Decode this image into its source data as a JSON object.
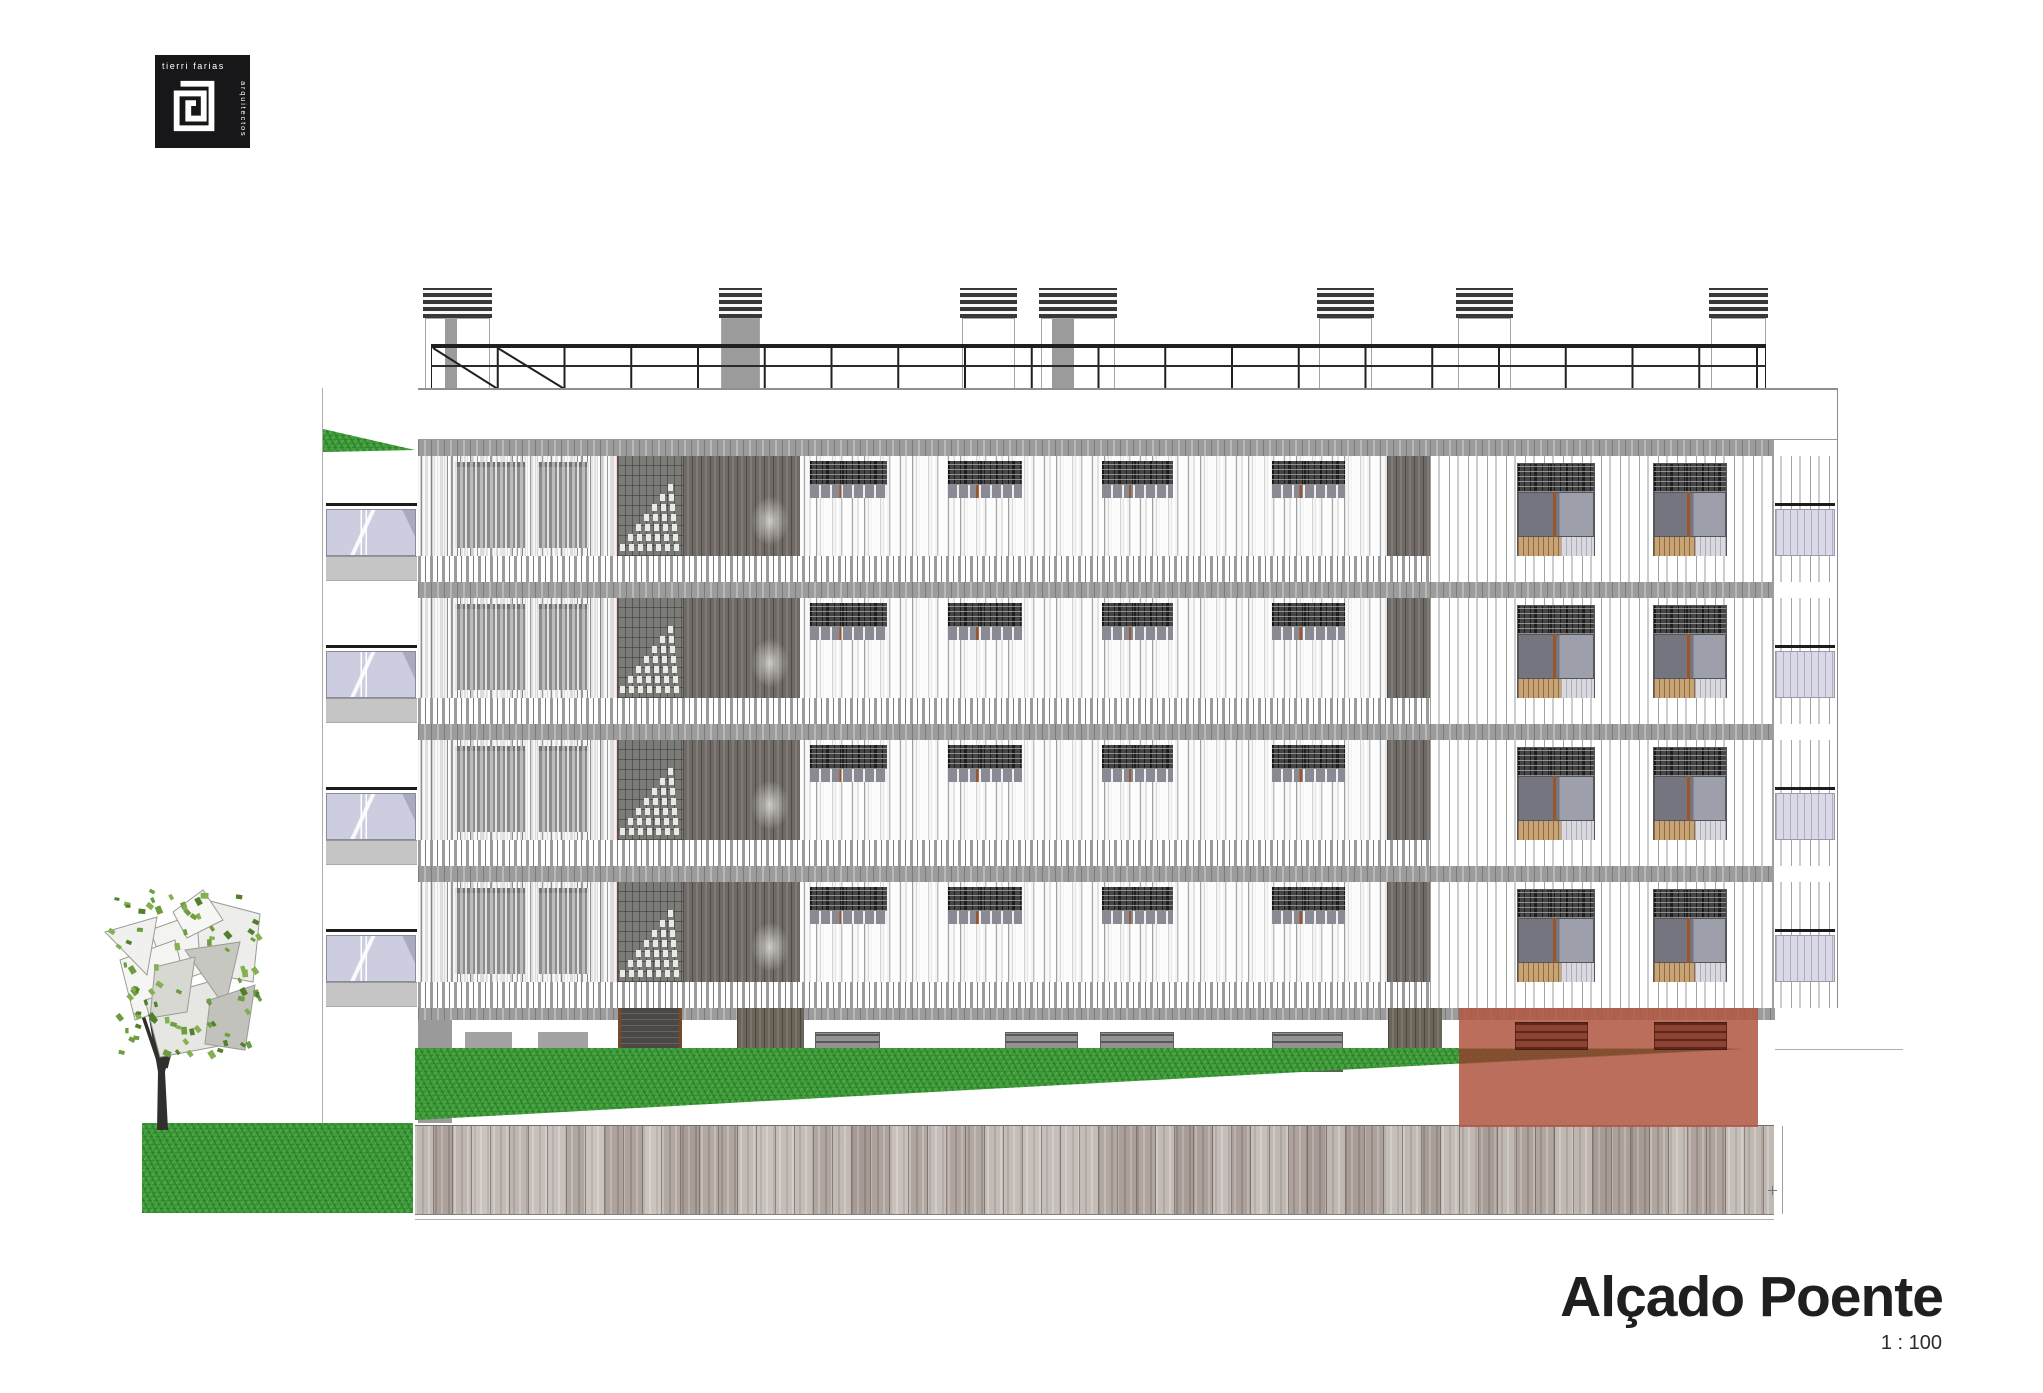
{
  "logo": {
    "text_top": "tierri farias",
    "text_side": "arquitectos",
    "bg": "#17171a"
  },
  "title": {
    "text": "Alçado Poente",
    "scale_label": "1 : 100"
  },
  "colors": {
    "paper": "#ffffff",
    "band_gray": "#9c9c9c",
    "pier_dark": "#6f6a66",
    "glass_blue": "#cdcde0",
    "grass_green": "#3f9e3b",
    "wood_gray": "#b3a9a3",
    "red_overlay": "rgba(177,89,68,0.87)",
    "accent_orange": "#9a552a",
    "rail_black": "#1c1c1c"
  },
  "drawing": {
    "floors": {
      "count": 4,
      "top": 440,
      "pitch": 142,
      "band_h": 16,
      "field_h": 100,
      "stub_h": 26
    },
    "facade": {
      "left": 418,
      "right": 1837,
      "zoneA": [
        418,
        617
      ],
      "tower": [
        617,
        683
      ],
      "pier1": [
        683,
        800
      ],
      "zoneB": [
        800,
        1387
      ],
      "pier2": [
        1387,
        1430
      ],
      "zoneC": [
        1430,
        1837
      ],
      "recess_x": 1773
    },
    "parapet": {
      "x": 323,
      "w": 1514,
      "y": 388,
      "h": 52
    },
    "top_wedge": {
      "x": 323,
      "y": 427,
      "w": 92,
      "h": 25
    },
    "left_column": {
      "x": 322,
      "y": 388,
      "w": 96,
      "h": 735
    },
    "chimneys": [
      {
        "x": 423,
        "w": 69,
        "stripe": [
          20,
          12
        ]
      },
      {
        "x": 719,
        "w": 43,
        "gray": true
      },
      {
        "x": 960,
        "w": 57
      },
      {
        "x": 1039,
        "w": 78,
        "stripe": [
          11,
          22
        ]
      },
      {
        "x": 1317,
        "w": 57
      },
      {
        "x": 1456,
        "w": 57
      },
      {
        "x": 1709,
        "w": 59
      }
    ],
    "chimney_cap": {
      "y": 288,
      "h": 30
    },
    "chimney_body": {
      "y": 318,
      "h": 70
    },
    "railing": {
      "x1": 431,
      "x2": 1766,
      "y_top": 342,
      "y_mid": 366,
      "y_bot": 388,
      "posts": 21,
      "diagonals": 2
    },
    "windows_A": [
      {
        "x": 455,
        "w": 70
      },
      {
        "x": 537,
        "w": 52
      }
    ],
    "grilles_B": [
      {
        "x": 810,
        "w": 77
      },
      {
        "x": 948,
        "w": 74
      },
      {
        "x": 1102,
        "w": 71
      },
      {
        "x": 1272,
        "w": 73
      }
    ],
    "windows_C": [
      {
        "x": 1517,
        "w": 78
      },
      {
        "x": 1653,
        "w": 74
      }
    ],
    "balconies_left": {
      "x": 326,
      "w": 91,
      "rail_dy": 63,
      "glass_dy": 69,
      "glass_h": 47,
      "slab_dy": 116,
      "slab_h": 25
    },
    "balconies_right": {
      "x": 1775,
      "w": 60,
      "rail_dy": 63,
      "glass_dy": 69,
      "glass_h": 47
    },
    "ground": {
      "band_y": 1008,
      "band_h": 12,
      "wall_y": 1020,
      "wall_h": 105,
      "wall_x": 418,
      "wall_r": 1775,
      "corner_pier": {
        "x": 418,
        "w": 34,
        "y": 1020,
        "h": 103
      },
      "openings": [
        {
          "x": 465,
          "w": 47,
          "notch": "right"
        },
        {
          "x": 538,
          "w": 50,
          "notch": "left"
        }
      ],
      "opening_y": 1032,
      "opening_h": 40,
      "door": {
        "x": 618,
        "w": 64,
        "y": 1008,
        "h": 66
      },
      "piers": [
        {
          "x": 737,
          "w": 67,
          "y": 1008,
          "h": 42
        },
        {
          "x": 1388,
          "w": 54,
          "y": 1008,
          "h": 41
        }
      ],
      "vents": [
        {
          "x": 815,
          "w": 65
        },
        {
          "x": 1005,
          "w": 73
        },
        {
          "x": 1100,
          "w": 74
        },
        {
          "x": 1272,
          "w": 71
        }
      ],
      "vent_y": 1032,
      "vent_h": 40
    },
    "grass_wedge": {
      "x": 415,
      "y": 1048,
      "w": 1330,
      "h": 72
    },
    "wood_wall": {
      "x": 415,
      "y": 1125,
      "w": 1359,
      "h": 90,
      "plank_w": 19
    },
    "under_line": {
      "x": 415,
      "y": 1219,
      "w": 1359
    },
    "grass_block": {
      "x": 142,
      "y": 1123,
      "w": 271,
      "h": 90
    },
    "red_box": {
      "x": 1459,
      "y": 1008,
      "w": 299,
      "h": 119,
      "grilles": [
        {
          "x": 56,
          "w": 73
        },
        {
          "x": 195,
          "w": 73
        }
      ],
      "grille_dy": 14,
      "grille_h": 28,
      "diag": "0,41 286,41 0,56"
    },
    "ground_line_right": {
      "x": 1775,
      "y": 1049,
      "w": 128
    },
    "tick": {
      "x": 1768,
      "y": 1190
    },
    "tree": {
      "x": 95,
      "y": 872,
      "w": 185,
      "h": 262,
      "trunk_path": "M62,258 L73,258 L70,200 L84,140 L78,137 L68,182 L60,144 L54,146 L63,200 Z",
      "branches": [
        "71,196 90,120",
        "67,200 45,135"
      ],
      "polys": [
        {
          "pts": "55,58 120,35 140,90 75,112",
          "fill": "#f3f3f1"
        },
        {
          "pts": "100,25 165,42 158,110 106,100",
          "fill": "#ededeb"
        },
        {
          "pts": "25,88 80,68 95,130 40,148",
          "fill": "#f5f5f3"
        },
        {
          "pts": "50,128 120,108 135,172 65,185",
          "fill": "#e6e6e2"
        },
        {
          "pts": "90,78 145,70 130,135",
          "fill": "#c7c7c1"
        },
        {
          "pts": "10,60 62,45 52,103",
          "fill": "#f0f0ee"
        },
        {
          "pts": "115,128 160,113 150,178 110,172",
          "fill": "#c2c2bc"
        },
        {
          "pts": "78,40 108,18 128,48 92,66",
          "fill": "#f7f7f5"
        },
        {
          "pts": "60,95 100,85 92,140 55,146",
          "fill": "#d8d8d2"
        }
      ],
      "leaf_colors": [
        "#6e9c40",
        "#527f2b",
        "#85b050"
      ],
      "leaf_count": 85
    }
  }
}
